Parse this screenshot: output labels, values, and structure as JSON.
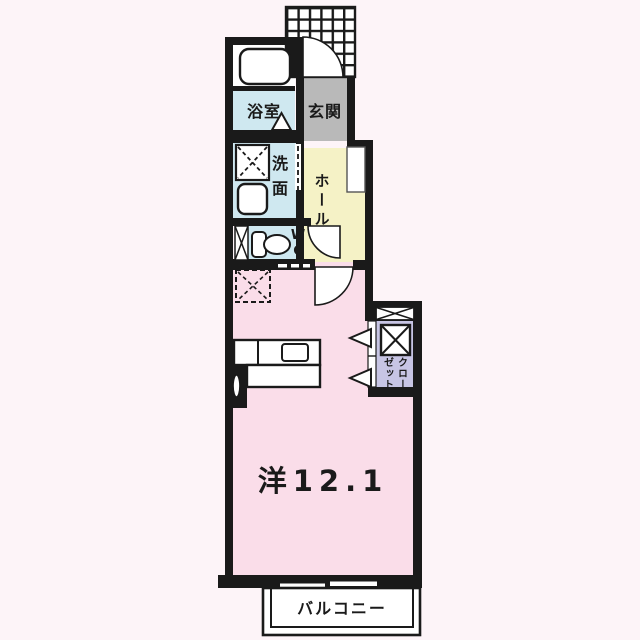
{
  "floorplan": {
    "rooms": {
      "bath": {
        "label": "浴室"
      },
      "entrance": {
        "label": "玄関"
      },
      "hall": {
        "label": "ホール"
      },
      "washroom": {
        "label": "洗面"
      },
      "wc": {
        "label": "WC"
      },
      "western_room": {
        "label": "洋12.1",
        "area_tatami": "12.1"
      },
      "closet": {
        "label": "クローゼット",
        "label_column_right": "クロー",
        "label_column_left": "ゼット"
      },
      "balcony": {
        "label": "バルコニー"
      }
    },
    "colors": {
      "wall": "#1a1a1a",
      "background": "#fdf4f8",
      "room_pink": "#fadde9",
      "room_blue": "#cfe8f0",
      "room_yellow": "#f5f2c6",
      "room_gray": "#b9b9b9",
      "room_lavender": "#c7c5e4",
      "fixture_white": "#ffffff"
    }
  }
}
